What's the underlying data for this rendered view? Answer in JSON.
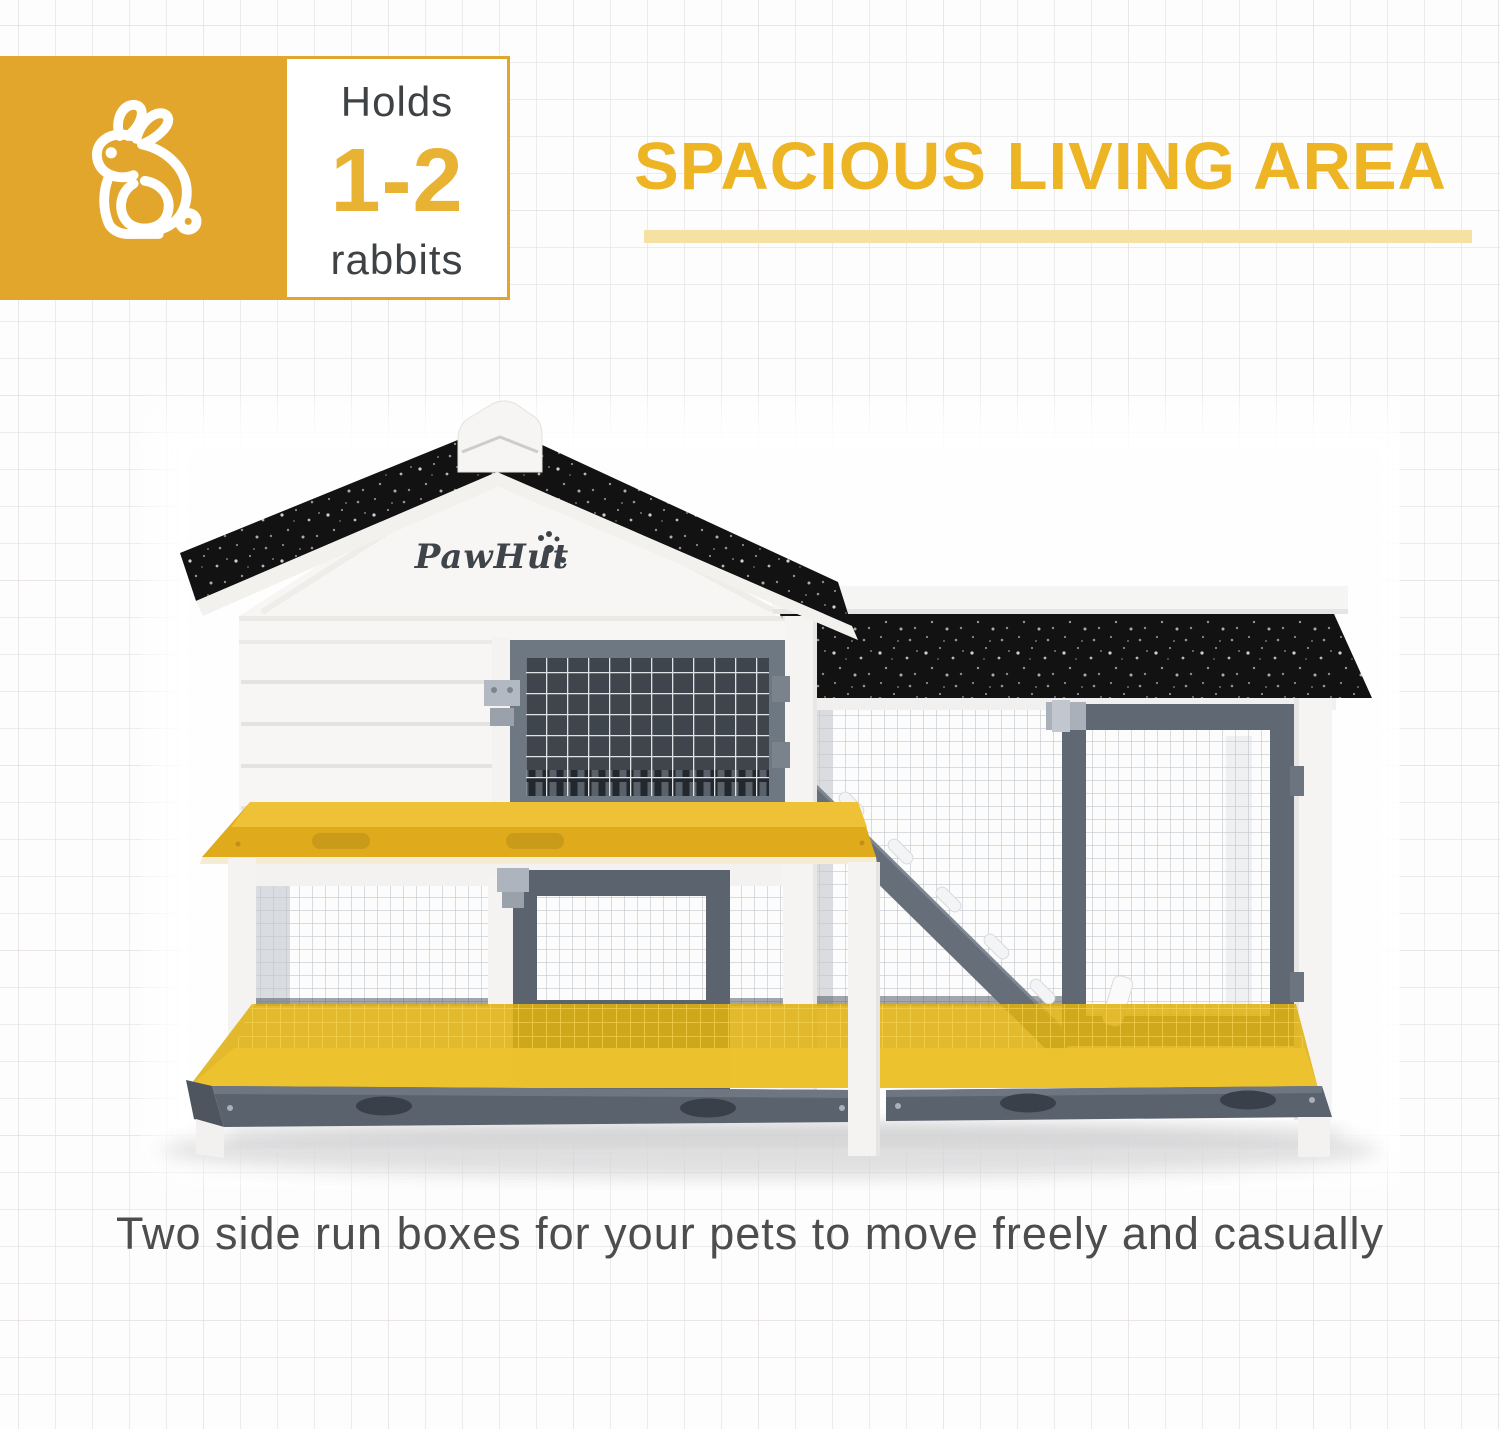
{
  "badge": {
    "icon": "rabbit-icon",
    "holds_label": "Holds",
    "capacity": "1-2",
    "unit_label": "rabbits"
  },
  "heading": {
    "title": "SPACIOUS LIVING AREA"
  },
  "caption": {
    "text": "Two side run boxes for your pets to move freely and casually"
  },
  "product": {
    "brand": "PawHut"
  },
  "colors": {
    "accent_gold": "#E2A62C",
    "capacity_gold": "#E8B232",
    "heading_gold": "#EDB424",
    "underline_gold": "#F5E2A3",
    "highlight_yellow": "#E5B50F",
    "roof_black": "#121212",
    "frame_white": "#F5F4F2",
    "door_gray": "#5F6873"
  }
}
